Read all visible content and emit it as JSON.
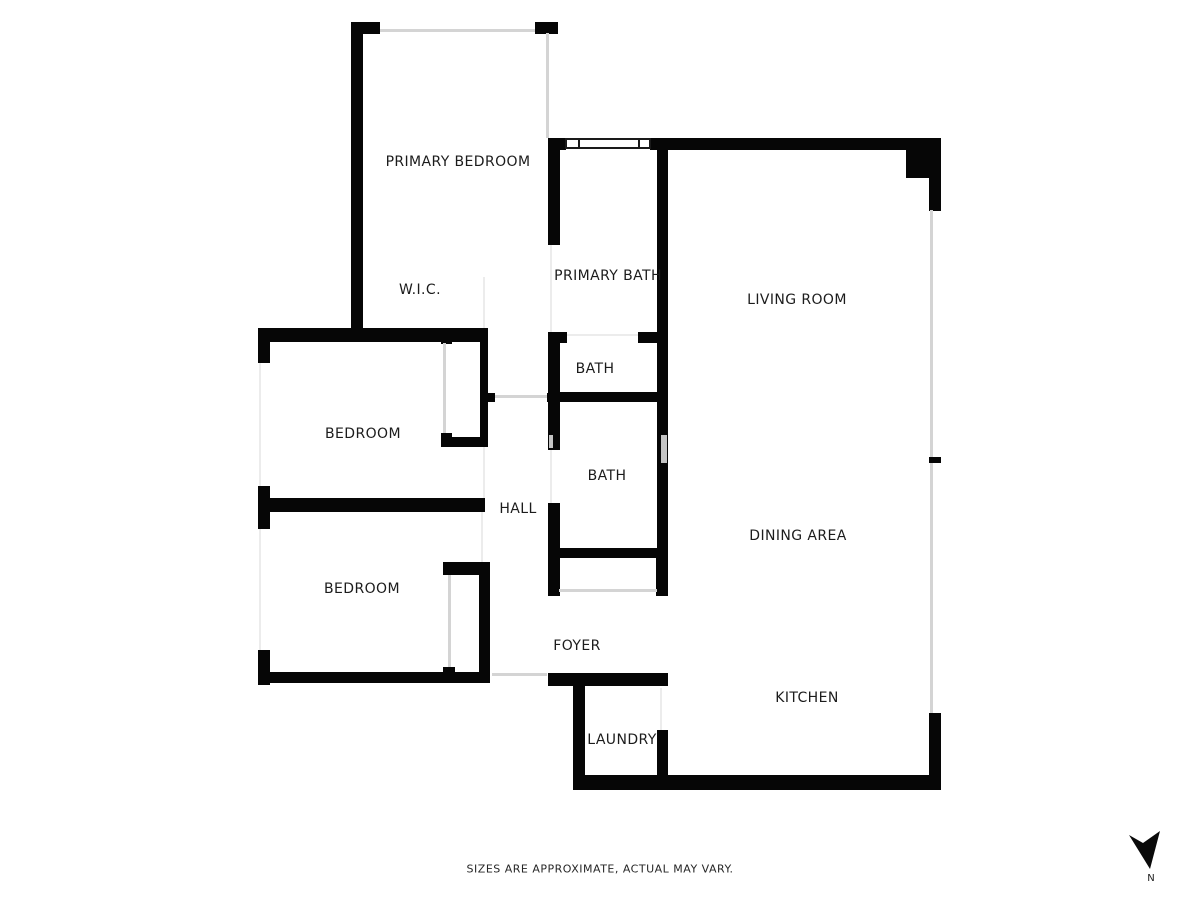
{
  "canvas": {
    "width": 1200,
    "height": 900,
    "background": "#ffffff"
  },
  "colors": {
    "wall": "#060606",
    "opening_light": "#d4d4d4",
    "opening_faint": "#ececec",
    "notch": "#c4c4c4",
    "label_text": "#1c1c1c"
  },
  "disclaimer": {
    "text": "SIZES ARE APPROXIMATE, ACTUAL MAY VARY.",
    "x": 600,
    "y": 869
  },
  "compass": {
    "label": "N",
    "arrow_points": "1129,835 1143,843 1160,831 1150,869",
    "label_x": 1151,
    "label_y": 881
  },
  "rooms": [
    {
      "id": "primary-bedroom",
      "label": "PRIMARY BEDROOM",
      "x": 458,
      "y": 162
    },
    {
      "id": "wic",
      "label": "W.I.C.",
      "x": 420,
      "y": 290
    },
    {
      "id": "primary-bath",
      "label": "PRIMARY BATH",
      "x": 608,
      "y": 276
    },
    {
      "id": "living-room",
      "label": "LIVING ROOM",
      "x": 797,
      "y": 300
    },
    {
      "id": "bath-upper",
      "label": "BATH",
      "x": 595,
      "y": 369
    },
    {
      "id": "bedroom-middle",
      "label": "BEDROOM",
      "x": 363,
      "y": 434
    },
    {
      "id": "bath-lower",
      "label": "BATH",
      "x": 607,
      "y": 476
    },
    {
      "id": "hall",
      "label": "HALL",
      "x": 518,
      "y": 509
    },
    {
      "id": "dining-area",
      "label": "DINING AREA",
      "x": 798,
      "y": 536
    },
    {
      "id": "bedroom-lower",
      "label": "BEDROOM",
      "x": 362,
      "y": 589
    },
    {
      "id": "foyer",
      "label": "FOYER",
      "x": 577,
      "y": 646
    },
    {
      "id": "kitchen",
      "label": "KITCHEN",
      "x": 807,
      "y": 698
    },
    {
      "id": "laundry",
      "label": "LAUNDRY",
      "x": 622,
      "y": 740
    }
  ],
  "walls": [
    [
      351,
      22,
      29,
      12
    ],
    [
      351,
      22,
      12,
      320
    ],
    [
      535,
      22,
      23,
      12
    ],
    [
      548,
      138,
      18,
      12
    ],
    [
      650,
      138,
      257,
      12
    ],
    [
      906,
      138,
      35,
      40
    ],
    [
      929,
      178,
      12,
      33
    ],
    [
      548,
      150,
      12,
      95
    ],
    [
      548,
      332,
      12,
      118
    ],
    [
      548,
      332,
      19,
      11
    ],
    [
      638,
      332,
      30,
      11
    ],
    [
      548,
      503,
      12,
      93
    ],
    [
      657,
      150,
      11,
      443
    ],
    [
      548,
      392,
      120,
      10
    ],
    [
      548,
      548,
      120,
      10
    ],
    [
      656,
      558,
      12,
      38
    ],
    [
      484,
      393,
      11,
      9
    ],
    [
      547,
      393,
      13,
      9
    ],
    [
      258,
      328,
      12,
      35
    ],
    [
      258,
      486,
      12,
      43
    ],
    [
      258,
      650,
      12,
      35
    ],
    [
      260,
      328,
      228,
      14
    ],
    [
      480,
      330,
      8,
      117
    ],
    [
      441,
      335,
      11,
      9
    ],
    [
      441,
      433,
      11,
      14
    ],
    [
      441,
      437,
      47,
      10
    ],
    [
      260,
      498,
      225,
      14
    ],
    [
      443,
      562,
      47,
      13
    ],
    [
      479,
      575,
      11,
      102
    ],
    [
      443,
      667,
      12,
      12
    ],
    [
      258,
      672,
      232,
      11
    ],
    [
      548,
      673,
      120,
      13
    ],
    [
      573,
      686,
      12,
      90
    ],
    [
      657,
      730,
      11,
      46
    ],
    [
      573,
      775,
      368,
      15
    ],
    [
      929,
      713,
      12,
      63
    ],
    [
      929,
      457,
      12,
      6
    ]
  ],
  "openings_light": [
    [
      380,
      29,
      155,
      3
    ],
    [
      546,
      33,
      3,
      105
    ],
    [
      930,
      210,
      3,
      247
    ],
    [
      930,
      463,
      3,
      250
    ],
    [
      559,
      589,
      98,
      3
    ],
    [
      443,
      343,
      3,
      90
    ],
    [
      448,
      575,
      3,
      92
    ],
    [
      492,
      673,
      55,
      3
    ],
    [
      495,
      395,
      52,
      3
    ]
  ],
  "openings_faint": [
    [
      483,
      277,
      2,
      51
    ],
    [
      550,
      245,
      2,
      87
    ],
    [
      567,
      334,
      71,
      2
    ],
    [
      550,
      450,
      2,
      53
    ],
    [
      483,
      447,
      2,
      51
    ],
    [
      481,
      512,
      2,
      50
    ],
    [
      660,
      688,
      2,
      42
    ],
    [
      259,
      363,
      2,
      123
    ],
    [
      259,
      529,
      2,
      121
    ]
  ],
  "notches": [
    [
      661,
      435,
      6,
      28
    ],
    [
      549,
      435,
      4,
      13
    ]
  ],
  "window": {
    "x": 565,
    "y": 138,
    "w": 86,
    "h": 11,
    "dividers": [
      11,
      71
    ]
  }
}
